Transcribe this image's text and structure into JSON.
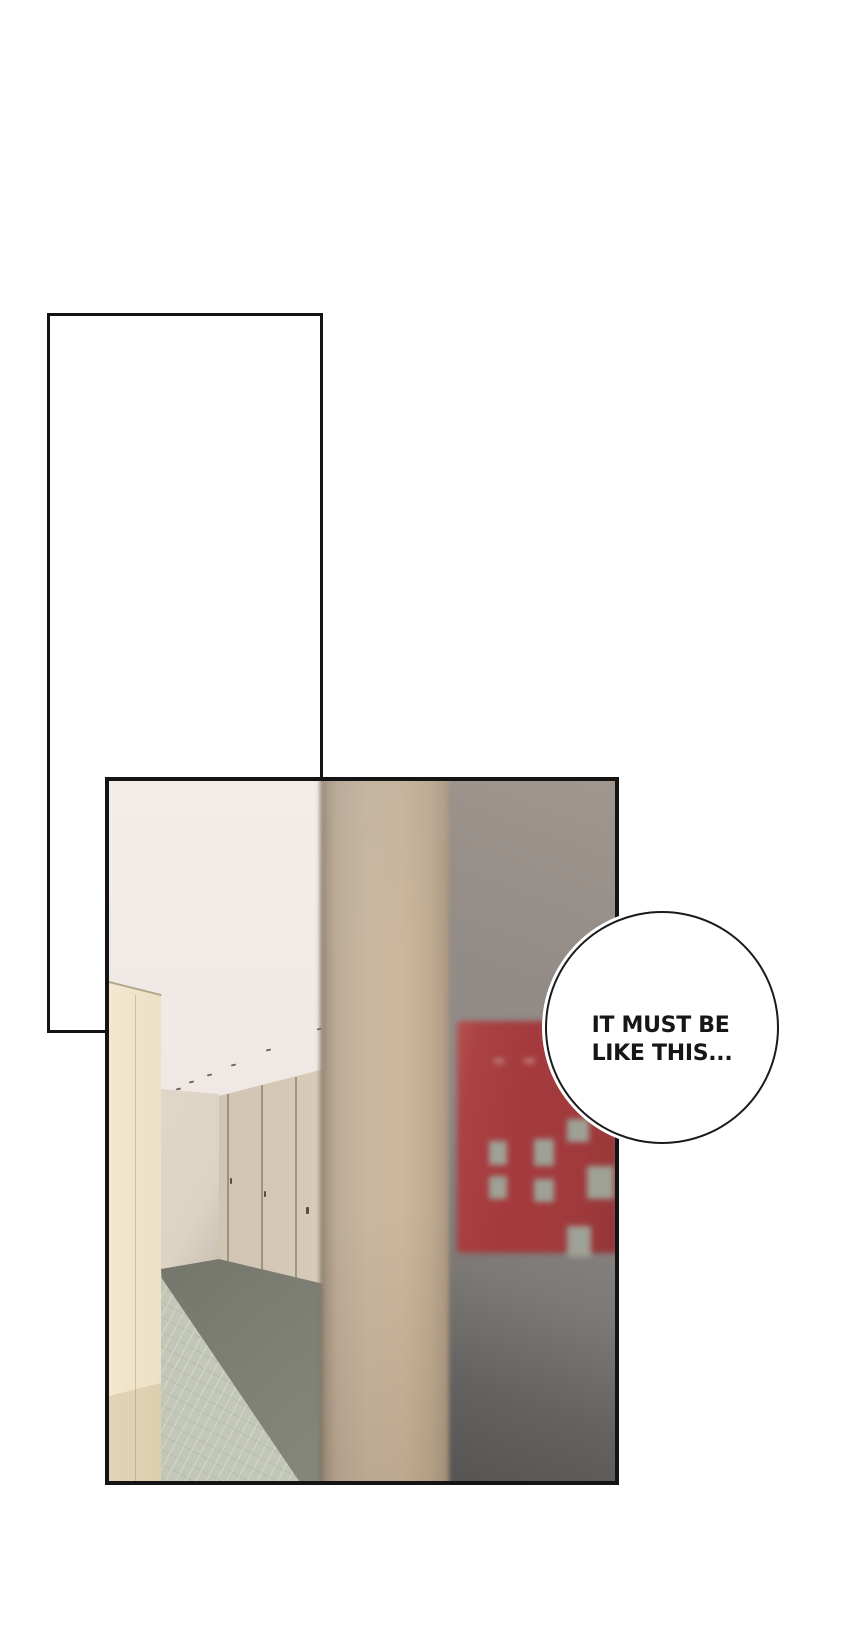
{
  "page": {
    "type": "comic-page",
    "background": "#ffffff",
    "panel_border_color": "#141414"
  },
  "speech_bubble": {
    "shape": "circle",
    "fill": "#ffffff",
    "border_color": "#1a1a1a",
    "text_color": "#161616",
    "lines": [
      "IT MUST BE",
      "LIKE THIS..."
    ],
    "full_text": "IT MUST BE LIKE THIS..."
  },
  "panels": {
    "empty_panel": {
      "content": "",
      "fill": "#ffffff"
    },
    "photo_panel": {
      "scene": "blurred hallway interior with wooden closet doors, out-of-focus wooden pillar and red pinboard wall"
    }
  },
  "photo_colors": {
    "ceiling": "#eee7e3",
    "left_pillar": "#e6d7b7",
    "closet_doors": "#d3c8b6",
    "shadow_wall_dark": "#6c675f",
    "carpet": "#74766c",
    "floor_tile": "#c3c7b8",
    "foreground_beam": "#c6b49d",
    "right_wall": "#8b8885",
    "red_pinboard": "#a43a3d",
    "pinned_photos": "#9ea195"
  }
}
